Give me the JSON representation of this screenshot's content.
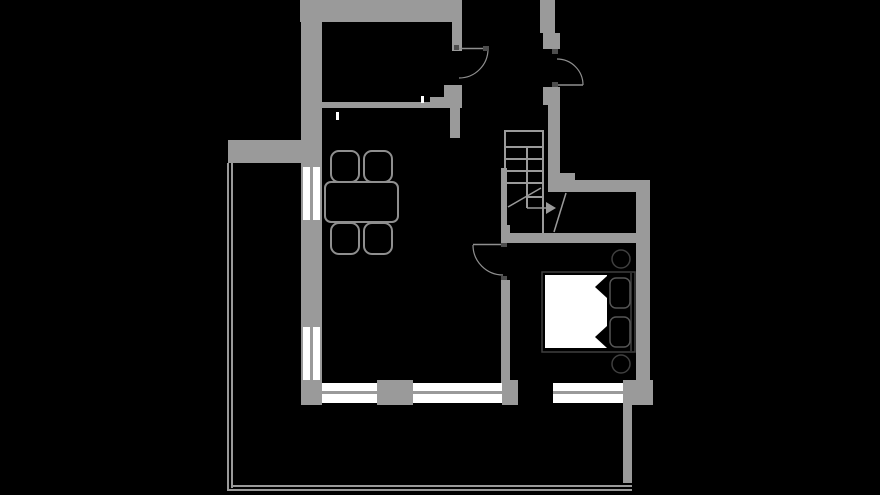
{
  "canvas": {
    "width": 880,
    "height": 495,
    "background": "#000000"
  },
  "palette": {
    "wall": "#9a9a9a",
    "white": "#ffffff",
    "black": "#000000",
    "line": "#8f8f8f",
    "dark": "#3f3f3f",
    "hinge": "#4d4d4d",
    "pillow": "#555555"
  },
  "shapes": [
    {
      "type": "rect",
      "name": "wall-top",
      "x": 300,
      "y": 0,
      "w": 162,
      "h": 22,
      "fill": "wall"
    },
    {
      "type": "rect",
      "name": "wall-door1-upper",
      "x": 452,
      "y": 22,
      "w": 10,
      "h": 29,
      "fill": "wall"
    },
    {
      "type": "rect",
      "name": "wall-left",
      "x": 301,
      "y": 0,
      "w": 21,
      "h": 405,
      "fill": "wall"
    },
    {
      "type": "rect",
      "name": "wall-inner-top-thin",
      "x": 322,
      "y": 102,
      "w": 110,
      "h": 6,
      "fill": "wall"
    },
    {
      "type": "rect",
      "name": "wall-inner-top-step1",
      "x": 430,
      "y": 97,
      "w": 16,
      "h": 11,
      "fill": "wall"
    },
    {
      "type": "rect",
      "name": "wall-inner-top-step2",
      "x": 444,
      "y": 85,
      "w": 18,
      "h": 23,
      "fill": "wall"
    },
    {
      "type": "rect",
      "name": "wall-hall-divider",
      "x": 450,
      "y": 108,
      "w": 10,
      "h": 30,
      "fill": "wall"
    },
    {
      "type": "rect",
      "name": "wall-entry-right-top",
      "x": 540,
      "y": 0,
      "w": 15,
      "h": 33,
      "fill": "wall"
    },
    {
      "type": "rect",
      "name": "wall-entry-right-bump",
      "x": 543,
      "y": 33,
      "w": 17,
      "h": 16,
      "fill": "wall"
    },
    {
      "type": "rect",
      "name": "wall-door2-lower",
      "x": 543,
      "y": 87,
      "w": 17,
      "h": 18,
      "fill": "wall"
    },
    {
      "type": "rect",
      "name": "wall-stair-right",
      "x": 548,
      "y": 87,
      "w": 12,
      "h": 94,
      "fill": "wall"
    },
    {
      "type": "rect",
      "name": "wall-stair-corner",
      "x": 560,
      "y": 173,
      "w": 15,
      "h": 19,
      "fill": "wall"
    },
    {
      "type": "rect",
      "name": "wall-void-top",
      "x": 548,
      "y": 180,
      "w": 102,
      "h": 12,
      "fill": "wall"
    },
    {
      "type": "rect",
      "name": "wall-right",
      "x": 636,
      "y": 180,
      "w": 14,
      "h": 225,
      "fill": "wall"
    },
    {
      "type": "rect",
      "name": "wall-bedroom-top",
      "x": 501,
      "y": 233,
      "w": 135,
      "h": 10,
      "fill": "wall"
    },
    {
      "type": "rect",
      "name": "wall-stair-left",
      "x": 501,
      "y": 168,
      "w": 6,
      "h": 65,
      "fill": "wall"
    },
    {
      "type": "rect",
      "name": "wall-bedroom-left-stub",
      "x": 501,
      "y": 225,
      "w": 9,
      "h": 8,
      "fill": "wall"
    },
    {
      "type": "rect",
      "name": "wall-bedroom-left",
      "x": 501,
      "y": 280,
      "w": 9,
      "h": 103,
      "fill": "wall"
    },
    {
      "type": "rect",
      "name": "wall-bottom-seg1",
      "x": 377,
      "y": 380,
      "w": 36,
      "h": 25,
      "fill": "wall"
    },
    {
      "type": "rect",
      "name": "wall-bottom-seg2",
      "x": 502,
      "y": 380,
      "w": 16,
      "h": 25,
      "fill": "wall"
    },
    {
      "type": "rect",
      "name": "wall-bottom-corner-right",
      "x": 623,
      "y": 380,
      "w": 30,
      "h": 25,
      "fill": "wall"
    },
    {
      "type": "rect",
      "name": "wall-right-lower",
      "x": 623,
      "y": 405,
      "w": 9,
      "h": 78,
      "fill": "wall"
    },
    {
      "type": "rect",
      "name": "terrace-wall-top",
      "x": 228,
      "y": 140,
      "w": 74,
      "h": 23,
      "fill": "wall"
    },
    {
      "type": "rect",
      "name": "terrace-railing-left-outer",
      "x": 227,
      "y": 163,
      "w": 2,
      "h": 328,
      "fill": "wall"
    },
    {
      "type": "rect",
      "name": "terrace-railing-left-inner",
      "x": 231,
      "y": 163,
      "w": 2,
      "h": 325,
      "fill": "wall"
    },
    {
      "type": "rect",
      "name": "terrace-railing-bottom-outer",
      "x": 227,
      "y": 489,
      "w": 405,
      "h": 2,
      "fill": "wall"
    },
    {
      "type": "rect",
      "name": "terrace-railing-bottom-inner",
      "x": 231,
      "y": 485,
      "w": 401,
      "h": 2,
      "fill": "wall"
    },
    {
      "type": "rect",
      "name": "window-left-upper",
      "x": 303,
      "y": 167,
      "w": 17,
      "h": 53,
      "fill": "white"
    },
    {
      "type": "rect",
      "name": "window-left-upper-mullion",
      "x": 310,
      "y": 167,
      "w": 3,
      "h": 53,
      "fill": "wall"
    },
    {
      "type": "rect",
      "name": "window-left-lower",
      "x": 303,
      "y": 327,
      "w": 17,
      "h": 53,
      "fill": "white"
    },
    {
      "type": "rect",
      "name": "window-left-lower-mullion",
      "x": 310,
      "y": 327,
      "w": 3,
      "h": 53,
      "fill": "wall"
    },
    {
      "type": "rect",
      "name": "window-bottom-1",
      "x": 322,
      "y": 383,
      "w": 55,
      "h": 20,
      "fill": "white"
    },
    {
      "type": "rect",
      "name": "window-bottom-1-mullion",
      "x": 322,
      "y": 391,
      "w": 55,
      "h": 3,
      "fill": "wall"
    },
    {
      "type": "rect",
      "name": "window-bottom-2",
      "x": 413,
      "y": 383,
      "w": 89,
      "h": 20,
      "fill": "white"
    },
    {
      "type": "rect",
      "name": "window-bottom-2-mullion",
      "x": 413,
      "y": 391,
      "w": 89,
      "h": 3,
      "fill": "wall"
    },
    {
      "type": "rect",
      "name": "window-bottom-3",
      "x": 553,
      "y": 383,
      "w": 70,
      "h": 20,
      "fill": "white"
    },
    {
      "type": "rect",
      "name": "window-bottom-3-mullion",
      "x": 553,
      "y": 391,
      "w": 70,
      "h": 3,
      "fill": "wall"
    },
    {
      "type": "rect",
      "name": "wall-tick-1",
      "x": 421,
      "y": 96,
      "w": 3,
      "h": 7,
      "fill": "white"
    },
    {
      "type": "rect",
      "name": "wall-tick-2",
      "x": 336,
      "y": 112,
      "w": 3,
      "h": 8,
      "fill": "white"
    },
    {
      "type": "line",
      "name": "door1-leaf",
      "x1": 459,
      "y1": 48.5,
      "x2": 488,
      "y2": 48.5,
      "stroke": "line",
      "sw": 1.5
    },
    {
      "type": "path",
      "name": "door1-swing-arc",
      "d": "M 488 49 A 29 29 0 0 1 459 78",
      "stroke": "line",
      "sw": 1.2
    },
    {
      "type": "rect",
      "name": "door1-hinge-a",
      "x": 454,
      "y": 45,
      "w": 5,
      "h": 5,
      "fill": "hinge"
    },
    {
      "type": "rect",
      "name": "door1-hinge-b",
      "x": 483,
      "y": 46,
      "w": 6,
      "h": 5,
      "fill": "hinge"
    },
    {
      "type": "line",
      "name": "door2-leaf",
      "x1": 557,
      "y1": 85,
      "x2": 583,
      "y2": 85,
      "stroke": "line",
      "sw": 1.5
    },
    {
      "type": "path",
      "name": "door2-swing-arc",
      "d": "M 583 85 A 26 26 0 0 0 557 59",
      "stroke": "line",
      "sw": 1.2
    },
    {
      "type": "rect",
      "name": "door2-hinge-a",
      "x": 552,
      "y": 49,
      "w": 6,
      "h": 5,
      "fill": "hinge"
    },
    {
      "type": "rect",
      "name": "door2-hinge-b",
      "x": 552,
      "y": 82,
      "w": 6,
      "h": 5,
      "fill": "hinge"
    },
    {
      "type": "line",
      "name": "door3-leaf",
      "x1": 473,
      "y1": 244.5,
      "x2": 502,
      "y2": 244.5,
      "stroke": "line",
      "sw": 1.5
    },
    {
      "type": "path",
      "name": "door3-swing-arc",
      "d": "M 473 245 A 30 30 0 0 0 503 275",
      "stroke": "line",
      "sw": 1.2
    },
    {
      "type": "rect",
      "name": "door3-hinge-a",
      "x": 501,
      "y": 243,
      "w": 6,
      "h": 4,
      "fill": "hinge"
    },
    {
      "type": "rect",
      "name": "door3-hinge-b",
      "x": 501,
      "y": 276,
      "w": 6,
      "h": 4,
      "fill": "hinge"
    },
    {
      "type": "rect",
      "name": "stairs-outline",
      "x": 505,
      "y": 131,
      "w": 38,
      "h": 104,
      "fill": "none",
      "stroke": "wall",
      "sw": 2
    },
    {
      "type": "line",
      "name": "stairs-tread-1",
      "x1": 505,
      "y1": 147,
      "x2": 543,
      "y2": 147,
      "stroke": "wall",
      "sw": 2
    },
    {
      "type": "line",
      "name": "stairs-tread-2",
      "x1": 505,
      "y1": 159,
      "x2": 543,
      "y2": 159,
      "stroke": "wall",
      "sw": 2
    },
    {
      "type": "line",
      "name": "stairs-tread-3",
      "x1": 505,
      "y1": 171,
      "x2": 543,
      "y2": 171,
      "stroke": "wall",
      "sw": 2
    },
    {
      "type": "line",
      "name": "stairs-tread-4",
      "x1": 505,
      "y1": 183,
      "x2": 543,
      "y2": 183,
      "stroke": "wall",
      "sw": 2
    },
    {
      "type": "line",
      "name": "stairs-tread-5-half",
      "x1": 527,
      "y1": 197,
      "x2": 543,
      "y2": 197,
      "stroke": "wall",
      "sw": 2
    },
    {
      "type": "line",
      "name": "stairs-divider",
      "x1": 527,
      "y1": 147,
      "x2": 527,
      "y2": 208,
      "stroke": "wall",
      "sw": 2
    },
    {
      "type": "line",
      "name": "stairs-walk-diagonal",
      "x1": 508,
      "y1": 207,
      "x2": 541,
      "y2": 188,
      "stroke": "wall",
      "sw": 1.5
    },
    {
      "type": "line",
      "name": "stairs-arrow-line",
      "x1": 527,
      "y1": 208,
      "x2": 546,
      "y2": 208,
      "stroke": "wall",
      "sw": 1.5
    },
    {
      "type": "polygon",
      "name": "stairs-arrow-head",
      "points": "546,202 556,208 546,214",
      "fill": "wall"
    },
    {
      "type": "line",
      "name": "void-break-diagonal",
      "x1": 566,
      "y1": 193,
      "x2": 554,
      "y2": 232,
      "stroke": "wall",
      "sw": 1.5
    },
    {
      "type": "rect",
      "name": "chair-top-left",
      "x": 331,
      "y": 151,
      "w": 28,
      "h": 31,
      "rx": 8,
      "fill": "black",
      "stroke": "line",
      "sw": 2
    },
    {
      "type": "rect",
      "name": "chair-top-right",
      "x": 364,
      "y": 151,
      "w": 28,
      "h": 31,
      "rx": 8,
      "fill": "black",
      "stroke": "line",
      "sw": 2
    },
    {
      "type": "rect",
      "name": "chair-bottom-left",
      "x": 331,
      "y": 223,
      "w": 28,
      "h": 31,
      "rx": 8,
      "fill": "black",
      "stroke": "line",
      "sw": 2
    },
    {
      "type": "rect",
      "name": "chair-bottom-right",
      "x": 364,
      "y": 223,
      "w": 28,
      "h": 31,
      "rx": 8,
      "fill": "black",
      "stroke": "line",
      "sw": 2
    },
    {
      "type": "rect",
      "name": "dining-table",
      "x": 325,
      "y": 182,
      "w": 73,
      "h": 40,
      "rx": 6,
      "fill": "black",
      "stroke": "line",
      "sw": 2
    },
    {
      "type": "rect",
      "name": "bed-frame",
      "x": 542,
      "y": 272,
      "w": 93,
      "h": 80,
      "fill": "black",
      "stroke": "dark",
      "sw": 1.5
    },
    {
      "type": "rect",
      "name": "bed-duvet",
      "x": 545,
      "y": 275,
      "w": 62,
      "h": 73,
      "fill": "white"
    },
    {
      "type": "polygon",
      "name": "bed-duvet-fold-top",
      "points": "607,276 607,298 595,287",
      "fill": "black"
    },
    {
      "type": "polygon",
      "name": "bed-duvet-fold-bottom",
      "points": "607,326 607,348 595,337",
      "fill": "black"
    },
    {
      "type": "line",
      "name": "bed-headboard-line",
      "x1": 631,
      "y1": 273,
      "x2": 631,
      "y2": 351,
      "stroke": "dark",
      "sw": 1.5
    },
    {
      "type": "rect",
      "name": "pillow-top",
      "x": 610,
      "y": 278,
      "w": 20,
      "h": 30,
      "rx": 6,
      "fill": "black",
      "stroke": "pillow",
      "sw": 1.5
    },
    {
      "type": "rect",
      "name": "pillow-bottom",
      "x": 610,
      "y": 317,
      "w": 20,
      "h": 30,
      "rx": 6,
      "fill": "black",
      "stroke": "pillow",
      "sw": 1.5
    },
    {
      "type": "circle",
      "name": "side-table-top",
      "cx": 621,
      "cy": 259,
      "r": 9,
      "fill": "black",
      "stroke": "dark",
      "sw": 1.5
    },
    {
      "type": "circle",
      "name": "side-table-bottom",
      "cx": 621,
      "cy": 364,
      "r": 9,
      "fill": "black",
      "stroke": "dark",
      "sw": 1.5
    }
  ]
}
